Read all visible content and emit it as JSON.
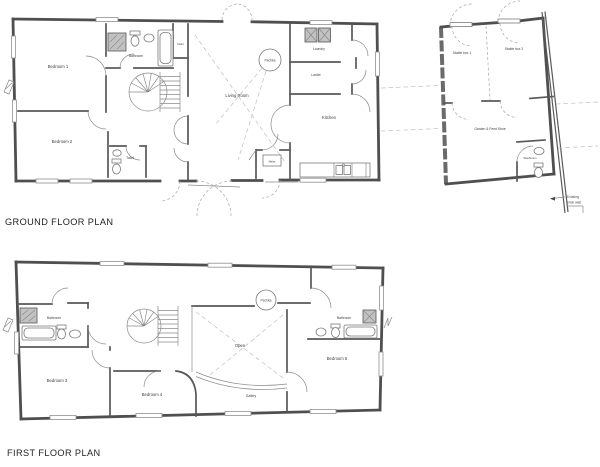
{
  "page": {
    "background": "#ffffff",
    "wall_color": "#4f4f4f",
    "dash_color": "#a8a8a8"
  },
  "titles": {
    "ground": "GROUND FLOOR PLAN",
    "first": "FIRST FLOOR PLAN"
  },
  "ground_floor": {
    "rooms": {
      "bedroom1": "Bedroom 1",
      "bathroom": "Bathroom",
      "boiler": "boiler",
      "bedroom2": "Bedroom 2",
      "toilet": "Toilet",
      "living_room": "Living Room",
      "pechka": "Pechka",
      "laundry": "Laundry",
      "larder": "Larder",
      "kitchen": "Kitchen",
      "meter": "Meter"
    }
  },
  "stable_block": {
    "rooms": {
      "stable_box_1": "Stable box 1",
      "stable_box_2": "Stable box 2",
      "garden_feed_store": "Garden & Feed Store",
      "washroom": "Washroom"
    },
    "annotation": {
      "line1": "Existing",
      "line2": "brick wall"
    }
  },
  "first_floor": {
    "rooms": {
      "bathroom_left": "Bathroom",
      "bedroom3": "Bedroom 3",
      "bedroom4": "Bedroom 4",
      "pechka": "Pechka",
      "open": "Open",
      "gallery": "Gallery",
      "bathroom_right": "Bathroom",
      "bedroom5": "Bedroom 5"
    }
  }
}
